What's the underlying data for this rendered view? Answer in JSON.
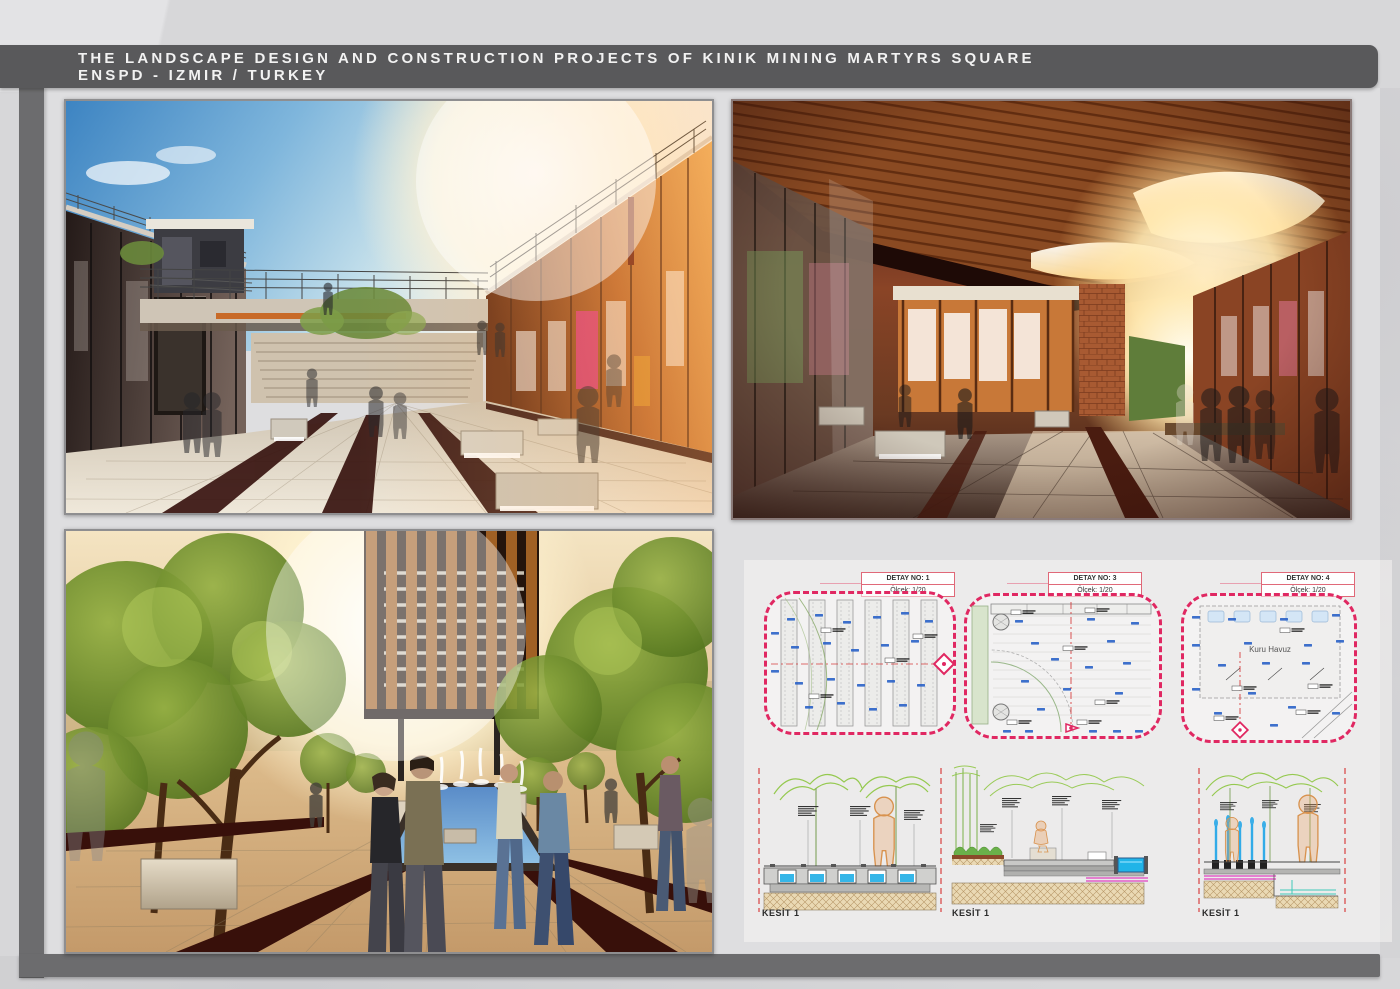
{
  "header": {
    "line1": "THE LANDSCAPE DESIGN AND CONSTRUCTION PROJECTS OF KINIK MINING MARTYRS SQUARE",
    "line2": "ENSPD - IZMIR / TURKEY"
  },
  "renderings": [
    {
      "name": "courtyard-exhibition-plaza",
      "alt": "Sunken courtyard flanked by glass gallery facades, bridge walkway above, stairs, dark linear corten channels, lit concrete benches, ghosted figures, blue sky with sun glare"
    },
    {
      "name": "covered-bazaar-street",
      "alt": "Covered street with sloping timber slat canopy, organic skylight openings glowing with sunlight, brick piers, green wall panel, glass shopfronts, benches and ghosted figures"
    },
    {
      "name": "fountain-plaza-with-trees",
      "alt": "Tree-lined plaza with linear fountain pool and jets, radiating corten bands in stone paving, cantilevered timber-louver building, pedestrians in warm sunlight"
    }
  ],
  "details": [
    {
      "label": "DETAY NO: 1",
      "scale": "Ölçek: 1/20"
    },
    {
      "label": "DETAY NO: 3",
      "scale": "Ölçek: 1/20"
    },
    {
      "label": "DETAY NO: 4",
      "scale": "Ölçek: 1/20",
      "note": "Kuru Havuz"
    }
  ],
  "sections": [
    {
      "label": "KESİT 1"
    },
    {
      "label": "KESİT 1"
    },
    {
      "label": "KESİT 1"
    }
  ],
  "colors": {
    "background": "#d7d7d9",
    "frame": "#6c6c6e",
    "title_bar": "#59595b",
    "detail_border": "#e02862",
    "annotation_blue": "#2a62c8",
    "centerline_red": "#d42a2a",
    "section_water": "#35b6e8",
    "section_magenta": "#e040c0",
    "section_green": "#8cc63f",
    "section_figure": "#e8a05a"
  }
}
